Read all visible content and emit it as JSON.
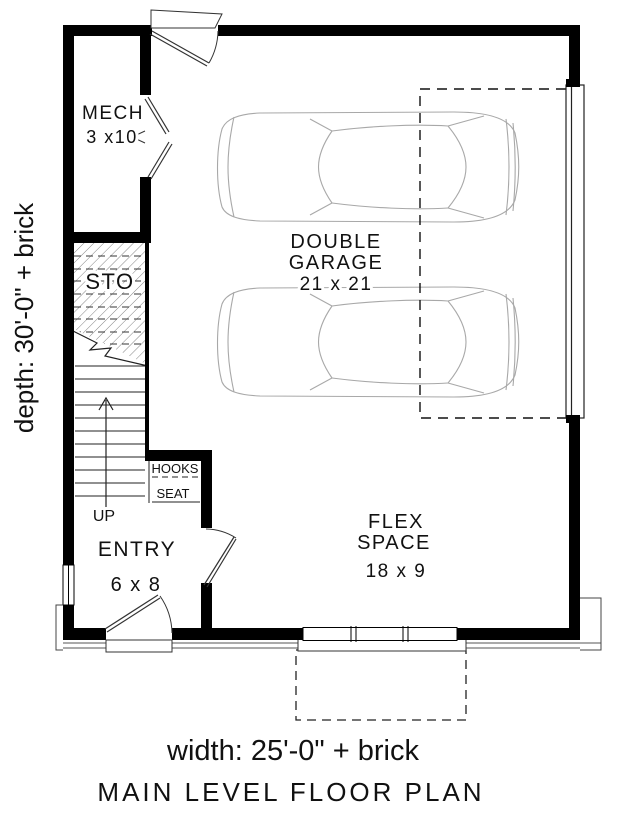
{
  "title": "MAIN LEVEL FLOOR PLAN",
  "dimensions": {
    "depth_label": "depth: 30'-0\" + brick",
    "width_label": "width: 25'-0\" + brick"
  },
  "rooms": {
    "mech": {
      "name": "MECH",
      "dims": "3 x10"
    },
    "sto": {
      "name": "STO"
    },
    "garage": {
      "name1": "DOUBLE",
      "name2": "GARAGE",
      "dims": "21 x 21"
    },
    "flex": {
      "name1": "FLEX",
      "name2": "SPACE",
      "dims": "18 x 9"
    },
    "entry": {
      "name": "ENTRY",
      "dims": "6 x 8"
    }
  },
  "features": {
    "hooks": "HOOKS",
    "seat": "SEAT",
    "up": "UP"
  },
  "colors": {
    "wall": "#000000",
    "line": "#333333",
    "car_line": "#a8a8a8",
    "background": "#ffffff"
  }
}
